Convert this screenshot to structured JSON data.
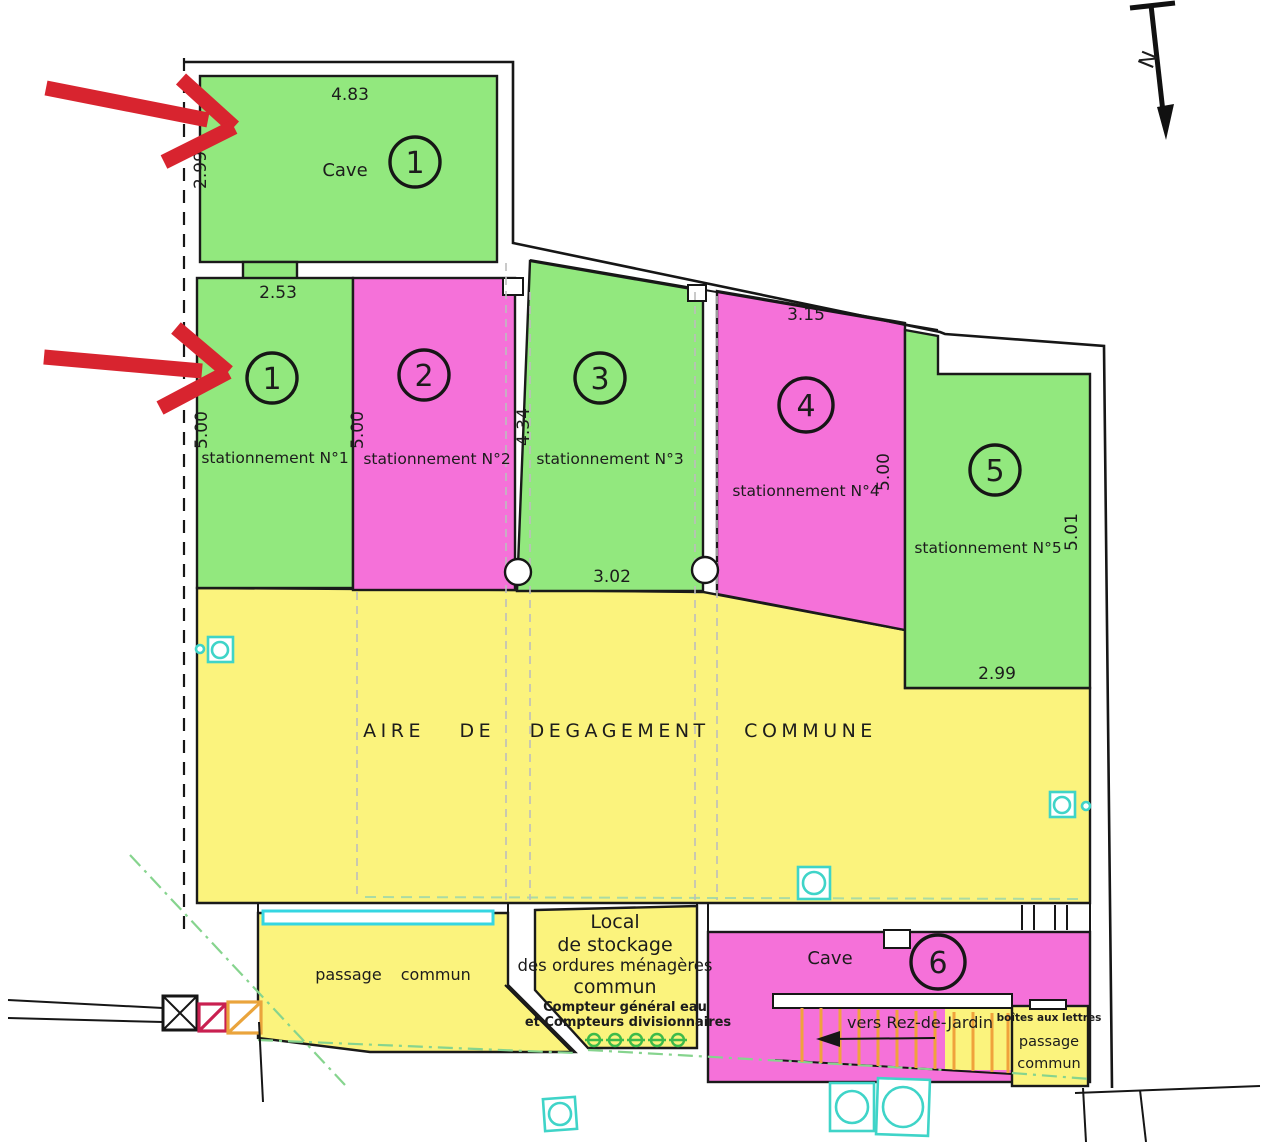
{
  "north": {
    "label": "N"
  },
  "colors": {
    "stall_green": "#92e87e",
    "stall_pink": "#f571d9",
    "common_yellow": "#fbf37d",
    "drain_cyan": "#35d6e2",
    "annotation_red": "#d8242f",
    "stair_orange": "#f0a23c",
    "boundary_green": "#86d48e"
  },
  "cave1": {
    "label": "Cave",
    "number": "1",
    "dim_top": "4.83",
    "dim_left": "2.99"
  },
  "stalls": [
    {
      "number": "1",
      "label": "stationnement N°1",
      "dim_top": "2.53",
      "dim_left": "5.00"
    },
    {
      "number": "2",
      "label": "stationnement N°2",
      "dim_left": "5.00"
    },
    {
      "number": "3",
      "label": "stationnement N°3",
      "dim_left": "4.34",
      "dim_bottom": "3.02"
    },
    {
      "number": "4",
      "label": "stationnement N°4",
      "dim_top": "3.15",
      "dim_right": "5.00"
    },
    {
      "number": "5",
      "label": "stationnement N°5",
      "dim_right": "5.01",
      "dim_bottom": "2.99"
    }
  ],
  "common_area": {
    "label": "AIRE DE DEGAGEMENT COMMUNE"
  },
  "passage_left": {
    "label": "passage commun"
  },
  "local": {
    "line1": "Local",
    "line2": "de stockage",
    "line3": "des ordures ménagères",
    "line4": "commun",
    "note1": "Compteur général eau",
    "note2": "et Compteurs divisionnaires"
  },
  "cave6": {
    "label": "Cave",
    "number": "6"
  },
  "stairs": {
    "label": "vers Rez-de-Jardin"
  },
  "mailbox": {
    "title": "boîtes aux lettres",
    "line2": "passage",
    "line3": "commun"
  }
}
